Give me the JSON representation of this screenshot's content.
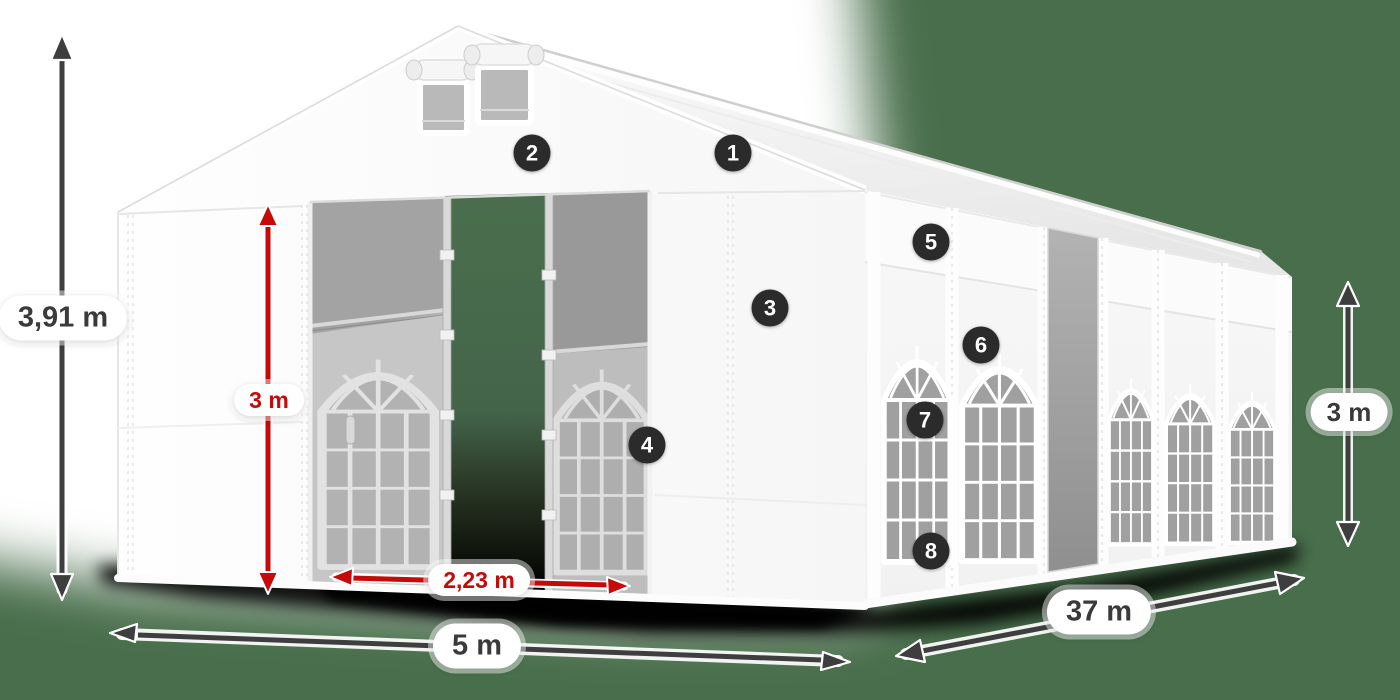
{
  "scene": {
    "description": "White marquee party tent 5x37 m, front doors open, dimension diagram",
    "background": "green"
  },
  "colors": {
    "background_green": "#486e4b",
    "accent_red": "#c60909",
    "arrow_dark": "#3e3e3e",
    "callout_bg": "#2b2b2b"
  },
  "dims": {
    "total_height": "3,91 m",
    "door_height": "3 m",
    "door_width": "2,23 m",
    "front_width": "5 m",
    "side_length": "37 m",
    "wall_height": "3 m"
  },
  "callouts": [
    {
      "number": "1"
    },
    {
      "number": "2"
    },
    {
      "number": "3"
    },
    {
      "number": "4"
    },
    {
      "number": "5"
    },
    {
      "number": "6"
    },
    {
      "number": "7"
    },
    {
      "number": "8"
    }
  ]
}
